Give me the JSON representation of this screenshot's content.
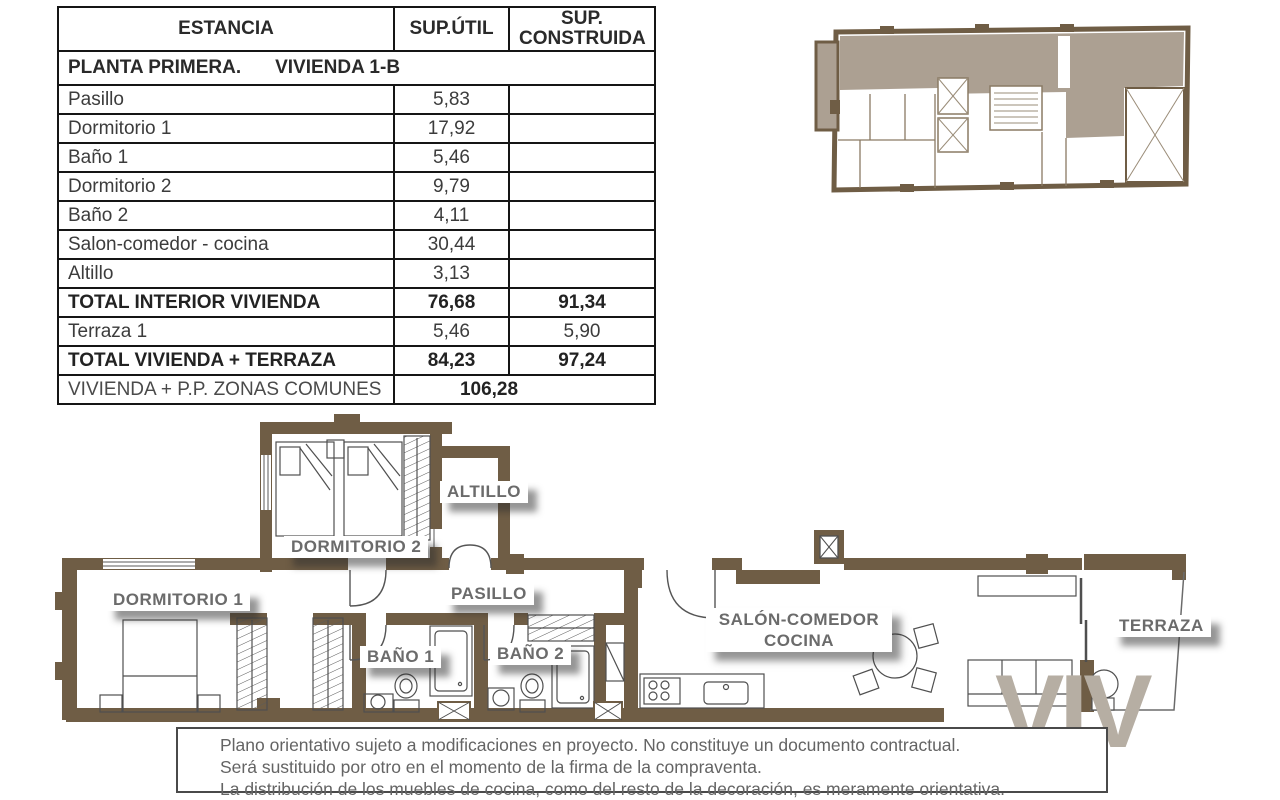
{
  "table": {
    "headers": {
      "col1": "ESTANCIA",
      "col2": "SUP.ÚTIL",
      "col3": "SUP. CONSTRUIDA"
    },
    "section": {
      "part1": "PLANTA PRIMERA.",
      "part2": "VIVIENDA 1-B"
    },
    "rows": [
      {
        "label": "Pasillo",
        "util": "5,83",
        "built": ""
      },
      {
        "label": "Dormitorio 1",
        "util": "17,92",
        "built": ""
      },
      {
        "label": "Baño 1",
        "util": "5,46",
        "built": ""
      },
      {
        "label": "Dormitorio 2",
        "util": "9,79",
        "built": ""
      },
      {
        "label": "Baño 2",
        "util": "4,11",
        "built": ""
      },
      {
        "label": "Salon-comedor - cocina",
        "util": "30,44",
        "built": ""
      },
      {
        "label": "Altillo",
        "util": "3,13",
        "built": ""
      },
      {
        "label": "TOTAL INTERIOR VIVIENDA",
        "util": "76,68",
        "built": "91,34"
      },
      {
        "label": "Terraza 1",
        "util": "5,46",
        "built": "5,90"
      },
      {
        "label": "TOTAL VIVIENDA + TERRAZA",
        "util": "84,23",
        "built": "97,24"
      }
    ],
    "footer": {
      "label": "VIVIENDA + P.P. ZONAS COMUNES",
      "value": "106,28"
    }
  },
  "plan": {
    "labels": {
      "dormitorio1": "DORMITORIO 1",
      "dormitorio2": "DORMITORIO 2",
      "altillo": "ALTILLO",
      "pasillo": "PASILLO",
      "bano1": "BAÑO 1",
      "bano2": "BAÑO 2",
      "salon_line1": "SALÓN-COMEDOR",
      "salon_line2": "COCINA",
      "terraza": "TERRAZA"
    }
  },
  "watermark": "VIV",
  "disclaimer": {
    "lines": [
      "Plano orientativo sujeto a modificaciones en proyecto. No constituye un documento contractual.",
      "Será sustituido por otro en el momento de la firma de la compraventa.",
      "La distribución de los muebles de cocina, como del resto de la decoración, es meramente orientativa."
    ]
  },
  "colors": {
    "wall": "#6f5d45",
    "highlight": "#aca092"
  }
}
